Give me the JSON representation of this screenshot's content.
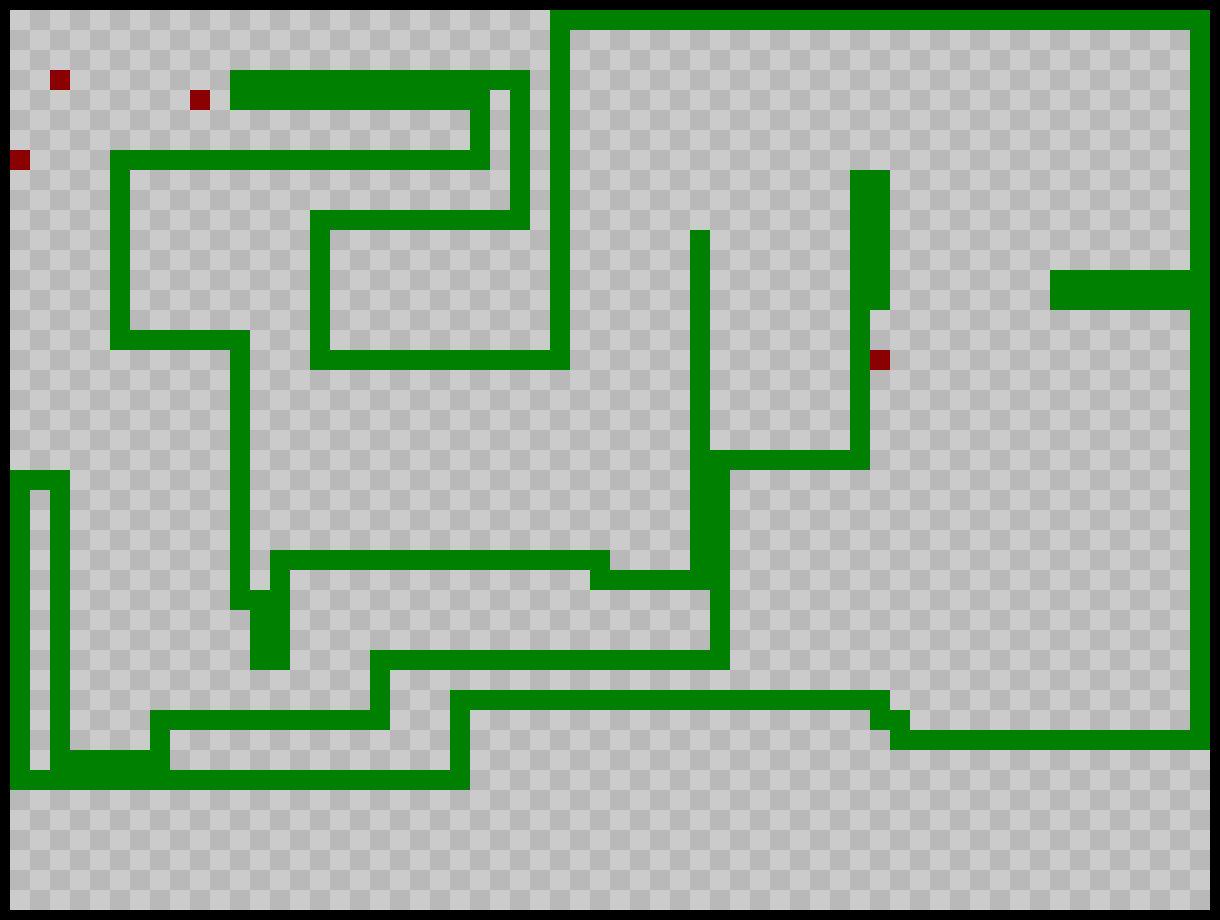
{
  "game": {
    "name": "snake-game-board",
    "board": {
      "cols": 60,
      "rows": 45,
      "cell_px": 20,
      "frame_px": 10,
      "checker_origin": "light-at-even-cell"
    },
    "colors": {
      "frame": "#000000",
      "checker_light": "#cbcbcb",
      "checker_dark": "#b9b9b9",
      "snake": "#008000",
      "food": "#8b0000"
    },
    "snake_segments_cells": [
      {
        "x": 27,
        "y": 0,
        "w": 33,
        "h": 1
      },
      {
        "x": 59,
        "y": 0,
        "w": 1,
        "h": 37
      },
      {
        "x": 52,
        "y": 13,
        "w": 7,
        "h": 2
      },
      {
        "x": 44,
        "y": 36,
        "w": 16,
        "h": 1
      },
      {
        "x": 43,
        "y": 35,
        "w": 2,
        "h": 1
      },
      {
        "x": 22,
        "y": 34,
        "w": 22,
        "h": 1
      },
      {
        "x": 22,
        "y": 34,
        "w": 1,
        "h": 5
      },
      {
        "x": 0,
        "y": 38,
        "w": 23,
        "h": 1
      },
      {
        "x": 0,
        "y": 23,
        "w": 1,
        "h": 16
      },
      {
        "x": 0,
        "y": 23,
        "w": 3,
        "h": 1
      },
      {
        "x": 2,
        "y": 23,
        "w": 1,
        "h": 15
      },
      {
        "x": 2,
        "y": 37,
        "w": 6,
        "h": 1
      },
      {
        "x": 7,
        "y": 35,
        "w": 1,
        "h": 3
      },
      {
        "x": 7,
        "y": 35,
        "w": 12,
        "h": 1
      },
      {
        "x": 18,
        "y": 32,
        "w": 1,
        "h": 4
      },
      {
        "x": 18,
        "y": 32,
        "w": 18,
        "h": 1
      },
      {
        "x": 35,
        "y": 22,
        "w": 1,
        "h": 10
      },
      {
        "x": 34,
        "y": 22,
        "w": 9,
        "h": 1
      },
      {
        "x": 42,
        "y": 8,
        "w": 1,
        "h": 15
      },
      {
        "x": 43,
        "y": 8,
        "w": 1,
        "h": 7
      },
      {
        "x": 34,
        "y": 11,
        "w": 1,
        "h": 18
      },
      {
        "x": 29,
        "y": 28,
        "w": 6,
        "h": 1
      },
      {
        "x": 13,
        "y": 27,
        "w": 17,
        "h": 1
      },
      {
        "x": 13,
        "y": 27,
        "w": 1,
        "h": 6
      },
      {
        "x": 12,
        "y": 29,
        "w": 1,
        "h": 4
      },
      {
        "x": 11,
        "y": 16,
        "w": 1,
        "h": 14
      },
      {
        "x": 5,
        "y": 16,
        "w": 7,
        "h": 1
      },
      {
        "x": 5,
        "y": 7,
        "w": 1,
        "h": 10
      },
      {
        "x": 5,
        "y": 7,
        "w": 19,
        "h": 1
      },
      {
        "x": 23,
        "y": 4,
        "w": 1,
        "h": 4
      },
      {
        "x": 11,
        "y": 4,
        "w": 13,
        "h": 1
      },
      {
        "x": 11,
        "y": 3,
        "w": 15,
        "h": 1
      },
      {
        "x": 25,
        "y": 3,
        "w": 1,
        "h": 8
      },
      {
        "x": 15,
        "y": 10,
        "w": 11,
        "h": 1
      },
      {
        "x": 15,
        "y": 10,
        "w": 1,
        "h": 8
      },
      {
        "x": 15,
        "y": 17,
        "w": 13,
        "h": 1
      },
      {
        "x": 27,
        "y": 0,
        "w": 1,
        "h": 18
      }
    ],
    "food_cells": [
      {
        "x": 2,
        "y": 3
      },
      {
        "x": 9,
        "y": 4
      },
      {
        "x": 0,
        "y": 7
      },
      {
        "x": 43,
        "y": 17
      }
    ]
  }
}
